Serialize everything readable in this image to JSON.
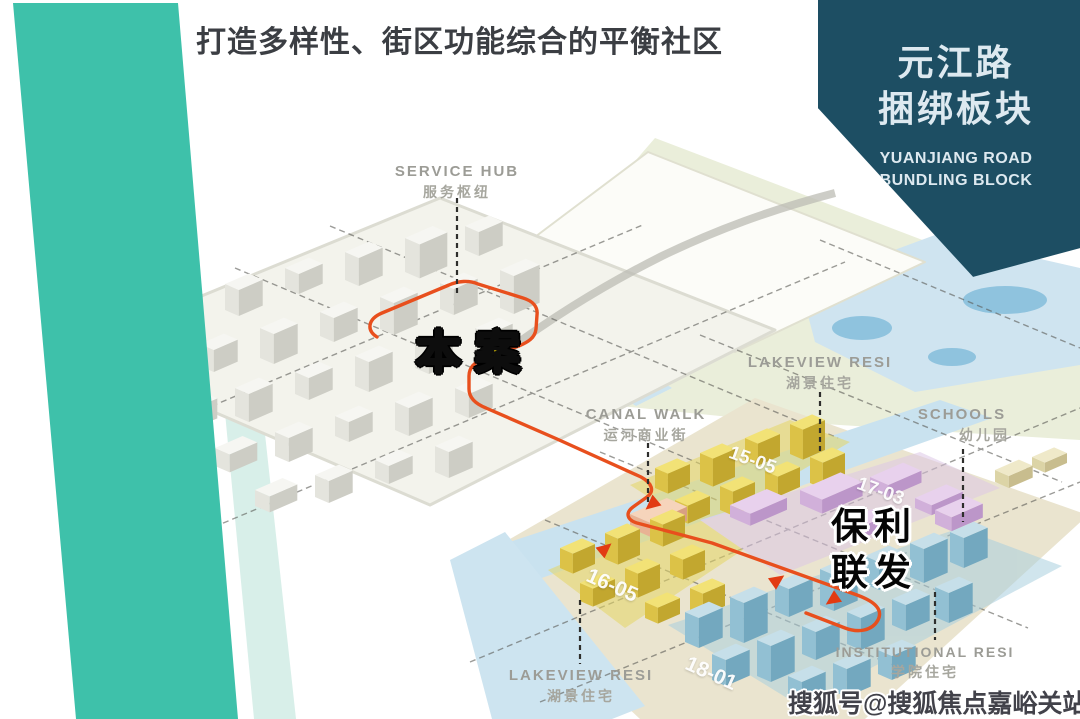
{
  "slide": {
    "title": "打造多样性、街区功能综合的平衡社区",
    "watermark": "搜狐号@搜狐焦点嘉峪关站"
  },
  "badge": {
    "zh_line1": "元江路",
    "zh_line2": "捆绑板块",
    "en_line1": "YUANJIANG ROAD",
    "en_line2": "BUNDLING BLOCK"
  },
  "map": {
    "site_label": "本案",
    "developer": {
      "line1": "保利",
      "line2": "联发"
    },
    "labels": {
      "service_hub": {
        "en": "SERVICE HUB",
        "zh": "服务枢纽"
      },
      "lakeview_right": {
        "en": "LAKEVIEW RESI",
        "zh": "湖景住宅"
      },
      "canal_walk": {
        "en": "CANAL WALK",
        "zh": "运河商业街"
      },
      "schools": {
        "en": "SCHOOLS",
        "zh": "幼儿园"
      },
      "lakeview_bottom": {
        "en": "LAKEVIEW RESI",
        "zh": "湖景住宅"
      },
      "institutional": {
        "en": "INSTITUTIONAL RESI",
        "zh": "学院住宅"
      }
    },
    "plots": {
      "p1505": "15-05",
      "p1703": "17-03",
      "p1605": "16-05",
      "p1801": "18-01"
    },
    "colors": {
      "ribbon": "#3ec1aa",
      "badge_bg": "#1d4e63",
      "route": "#e84f1d",
      "site_text": "#ffdf00",
      "water": "#cfe4f0"
    }
  }
}
